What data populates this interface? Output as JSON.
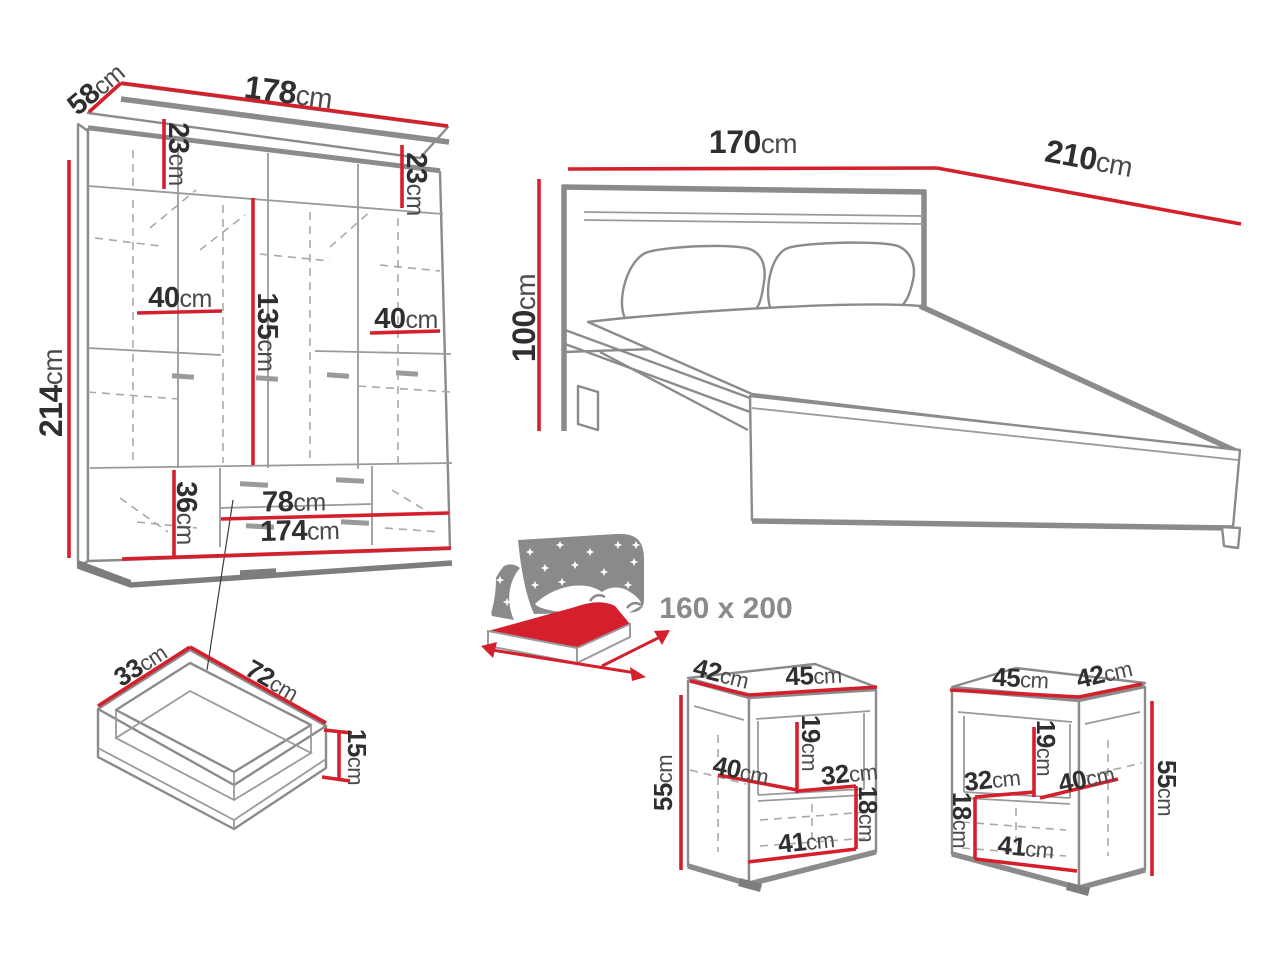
{
  "colors": {
    "dimension_line": "#d4202c",
    "furniture_outline": "#8b8b8b",
    "label_text": "#2f2f2f",
    "muted_text": "#8a8a8a"
  },
  "wardrobe": {
    "width": {
      "value": "178",
      "unit": "cm"
    },
    "depth": {
      "value": "58",
      "unit": "cm"
    },
    "height": {
      "value": "214",
      "unit": "cm"
    },
    "top_shelf_left_height": {
      "value": "23",
      "unit": "cm"
    },
    "top_shelf_right_height": {
      "value": "23",
      "unit": "cm"
    },
    "left_section_width": {
      "value": "40",
      "unit": "cm"
    },
    "right_section_width": {
      "value": "40",
      "unit": "cm"
    },
    "hanging_space_height": {
      "value": "135",
      "unit": "cm"
    },
    "bottom_section_height": {
      "value": "36",
      "unit": "cm"
    },
    "drawer_width": {
      "value": "78",
      "unit": "cm"
    },
    "internal_width": {
      "value": "174",
      "unit": "cm"
    }
  },
  "bed": {
    "width": {
      "value": "170",
      "unit": "cm"
    },
    "length": {
      "value": "210",
      "unit": "cm"
    },
    "headboard_height": {
      "value": "100",
      "unit": "cm"
    }
  },
  "mattress": {
    "size": "160 x 200"
  },
  "drawer": {
    "depth": {
      "value": "33",
      "unit": "cm"
    },
    "width": {
      "value": "72",
      "unit": "cm"
    },
    "height": {
      "value": "15",
      "unit": "cm"
    }
  },
  "nightstand_left": {
    "depth": {
      "value": "42",
      "unit": "cm"
    },
    "width": {
      "value": "45",
      "unit": "cm"
    },
    "height": {
      "value": "55",
      "unit": "cm"
    },
    "niche_height": {
      "value": "19",
      "unit": "cm"
    },
    "shelf_depth": {
      "value": "40",
      "unit": "cm"
    },
    "niche_width": {
      "value": "32",
      "unit": "cm"
    },
    "drawer_height": {
      "value": "18",
      "unit": "cm"
    },
    "internal_width": {
      "value": "41",
      "unit": "cm"
    }
  },
  "nightstand_right": {
    "width": {
      "value": "45",
      "unit": "cm"
    },
    "depth": {
      "value": "42",
      "unit": "cm"
    },
    "height": {
      "value": "55",
      "unit": "cm"
    },
    "niche_height": {
      "value": "19",
      "unit": "cm"
    },
    "niche_width": {
      "value": "32",
      "unit": "cm"
    },
    "shelf_depth": {
      "value": "40",
      "unit": "cm"
    },
    "drawer_height": {
      "value": "18",
      "unit": "cm"
    },
    "internal_width": {
      "value": "41",
      "unit": "cm"
    }
  }
}
